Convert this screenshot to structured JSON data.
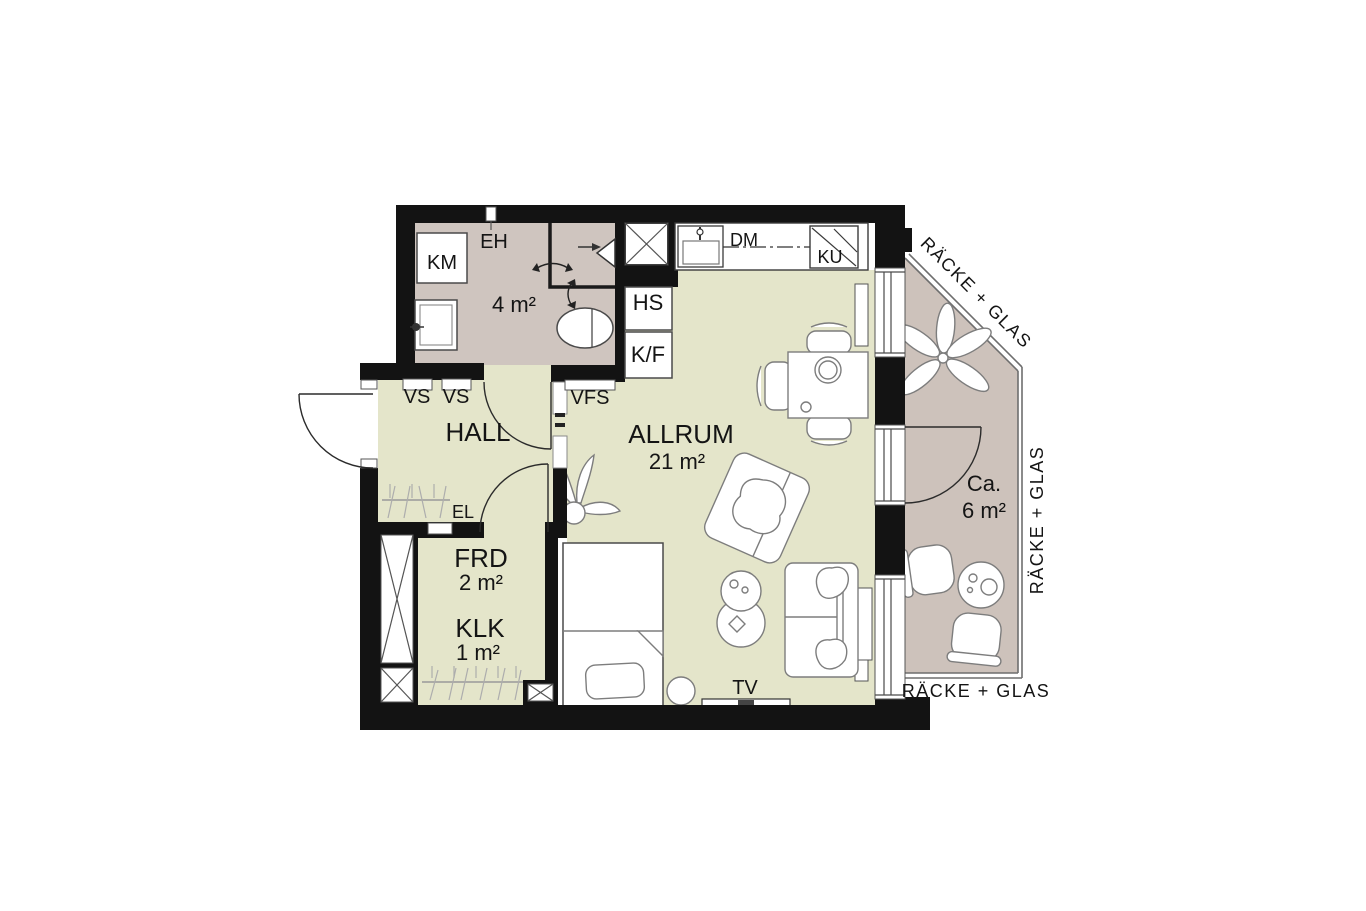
{
  "colors": {
    "wall": "#131313",
    "floor_living": "#e4e5ca",
    "floor_wet": "#cfc5bf",
    "floor_balcony": "#cdc2bb",
    "outline": "#7d7d7d",
    "background": "#ffffff"
  },
  "labels": {
    "km": "KM",
    "eh": "EH",
    "bath_area": "4 m²",
    "hs": "HS",
    "kf": "K/F",
    "dm": "DM",
    "ku": "KU",
    "vs_left": "VS",
    "vs_right": "VS",
    "vfs": "VFS",
    "hall": "HALL",
    "allrum": "ALLRUM",
    "allrum_area": "21 m²",
    "el": "EL",
    "frd": "FRD",
    "frd_area": "2 m²",
    "klk": "KLK",
    "klk_area": "1 m²",
    "tv": "TV",
    "balcony_ca": "Ca.",
    "balcony_area": "6 m²",
    "railing_diagonal": "RÄCKE + GLAS",
    "railing_right": "RÄCKE + GLAS",
    "railing_bottom": "RÄCKE + GLAS"
  }
}
